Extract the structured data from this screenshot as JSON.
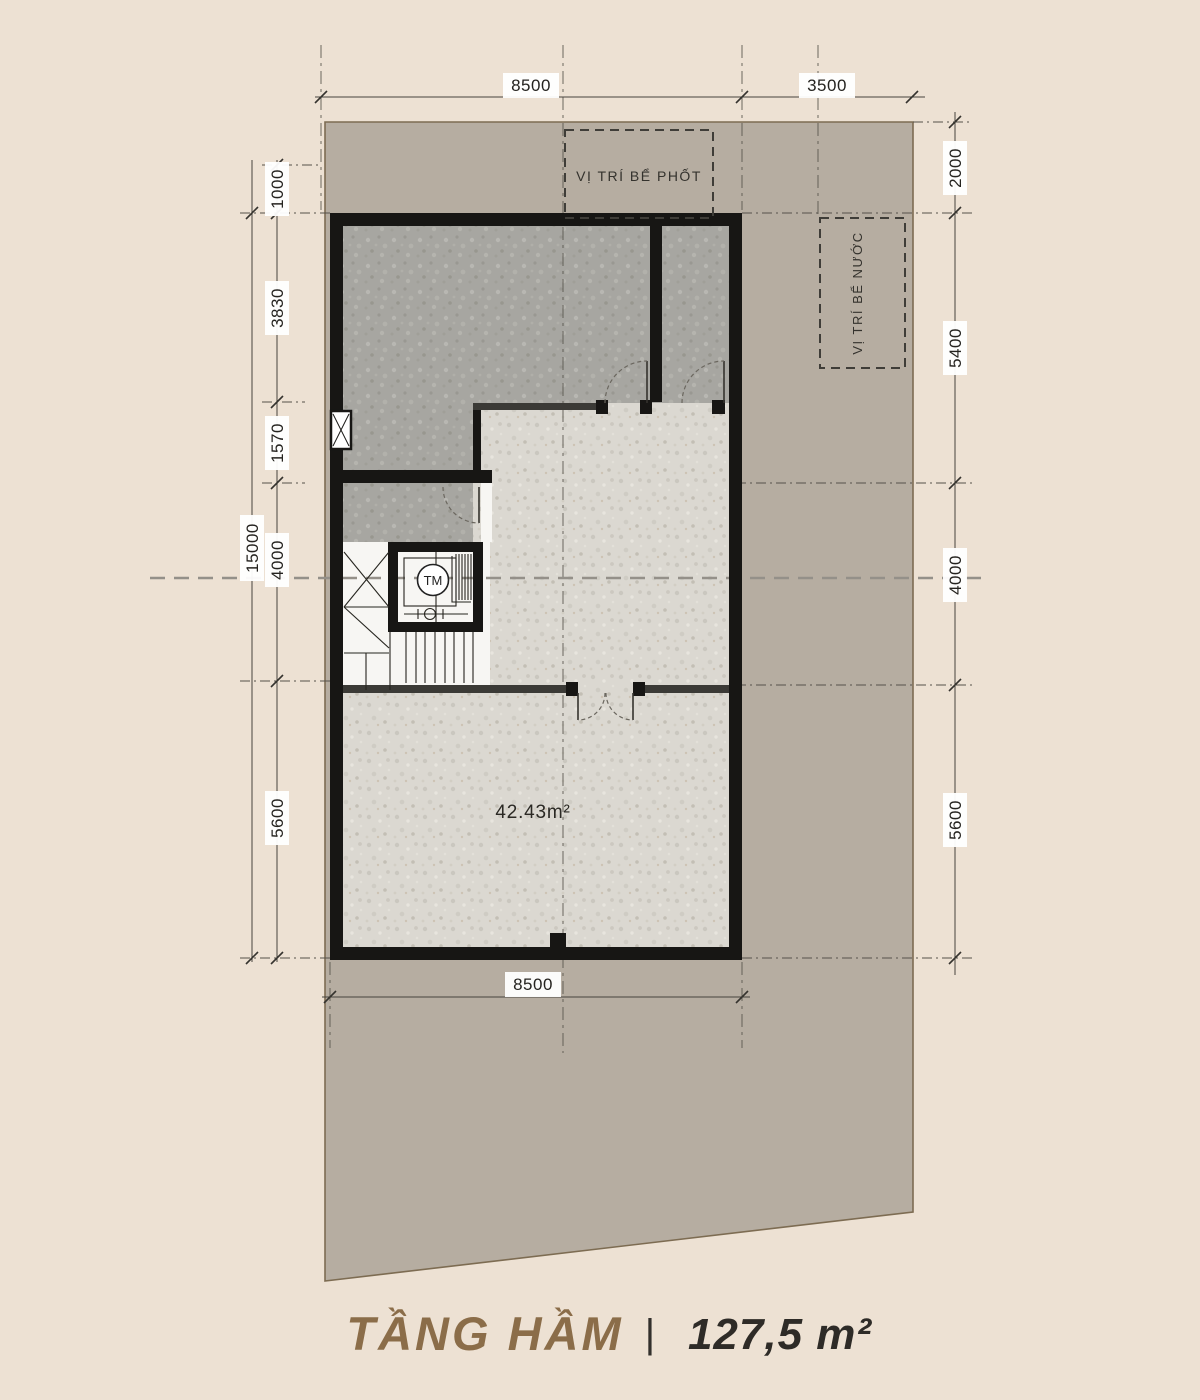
{
  "title": {
    "name": "TẦNG HẦM",
    "separator": "|",
    "area": "127,5 m²"
  },
  "labels": {
    "septic_tank": "VỊ TRÍ BỂ PHỐT",
    "water_tank": "VỊ TRÍ BỂ NƯỚC",
    "elevator": "TM",
    "room_area": "42.43m²"
  },
  "dims": {
    "top_8500": "8500",
    "top_3500": "3500",
    "bottom_8500": "8500",
    "left_overall": "15000",
    "left_1000": "1000",
    "left_3830": "3830",
    "left_1570": "1570",
    "left_4000": "4000",
    "left_5600": "5600",
    "right_2000": "2000",
    "right_5400": "5400",
    "right_4000": "4000",
    "right_5600": "5600"
  },
  "colors": {
    "page_bg": "#ede1d3",
    "lot_fill": "#b6ada1",
    "lot_stroke": "#7d6c52",
    "wall": "#171614",
    "dark_floor": "#a7a6a1",
    "light_floor": "#dbd8d1",
    "title_brown": "#8b6d49"
  }
}
